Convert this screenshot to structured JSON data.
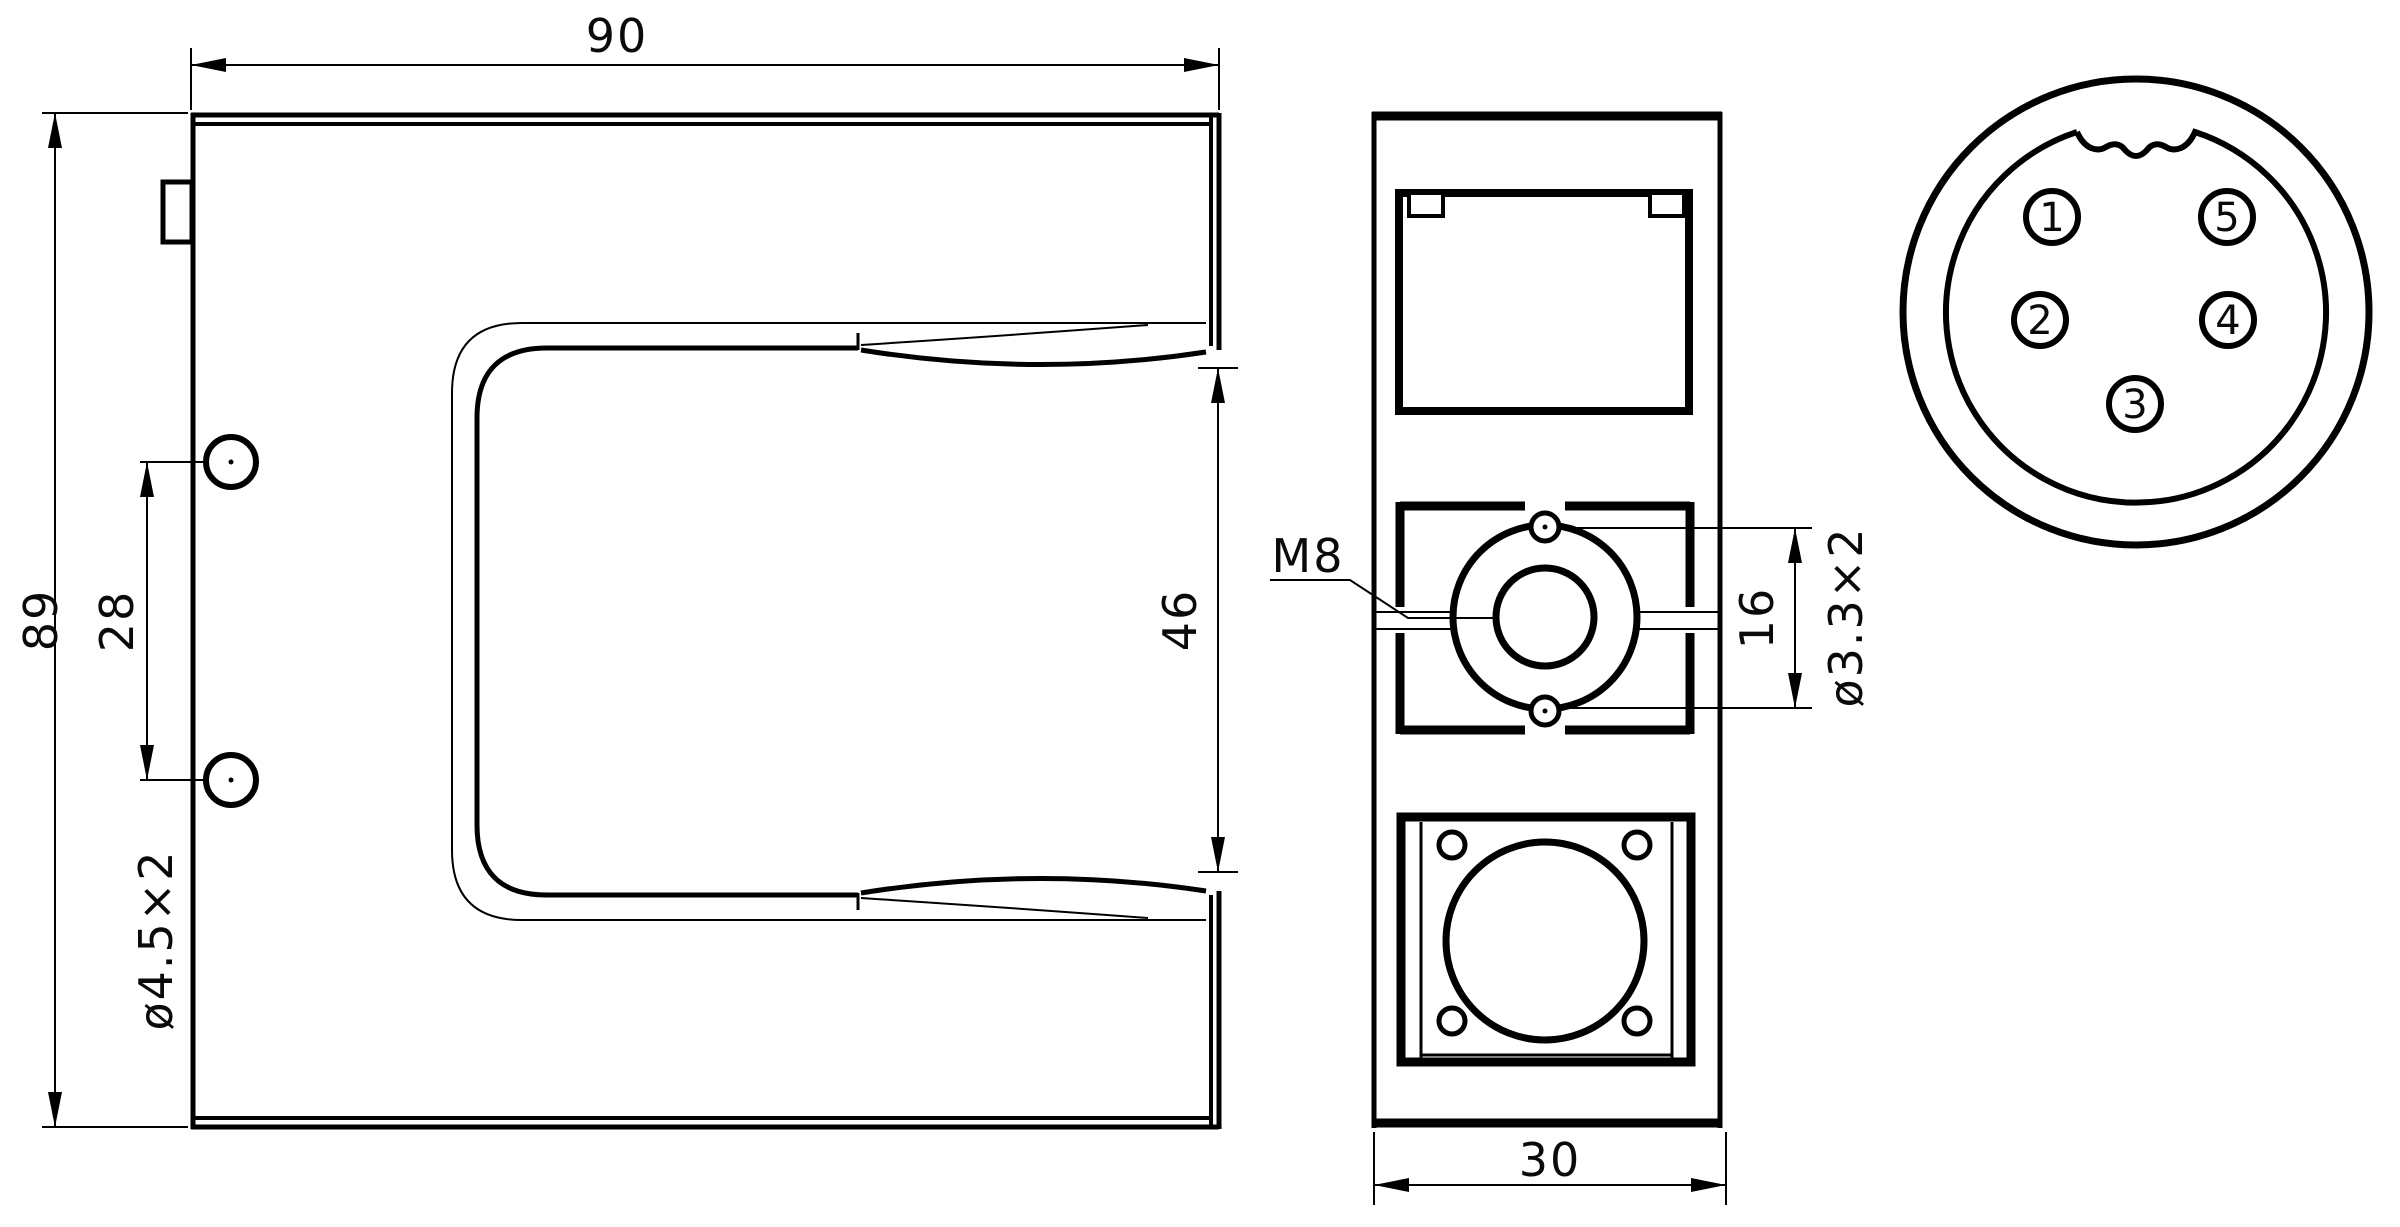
{
  "colors": {
    "line": "#000000",
    "background": "#ffffff"
  },
  "front_view": {
    "width_dim": "90",
    "height_dim": "89",
    "hole_spacing_dim": "28",
    "hole_size_note": "ø4.5×2",
    "slot_gap_dim": "46"
  },
  "side_view": {
    "thread_label": "M8",
    "pin_hole_spacing_dim": "16",
    "pin_hole_size_note": "ø3.3×2",
    "width_dim": "30"
  },
  "connector": {
    "pins": [
      {
        "number": "1"
      },
      {
        "number": "2"
      },
      {
        "number": "3"
      },
      {
        "number": "4"
      },
      {
        "number": "5"
      }
    ]
  }
}
